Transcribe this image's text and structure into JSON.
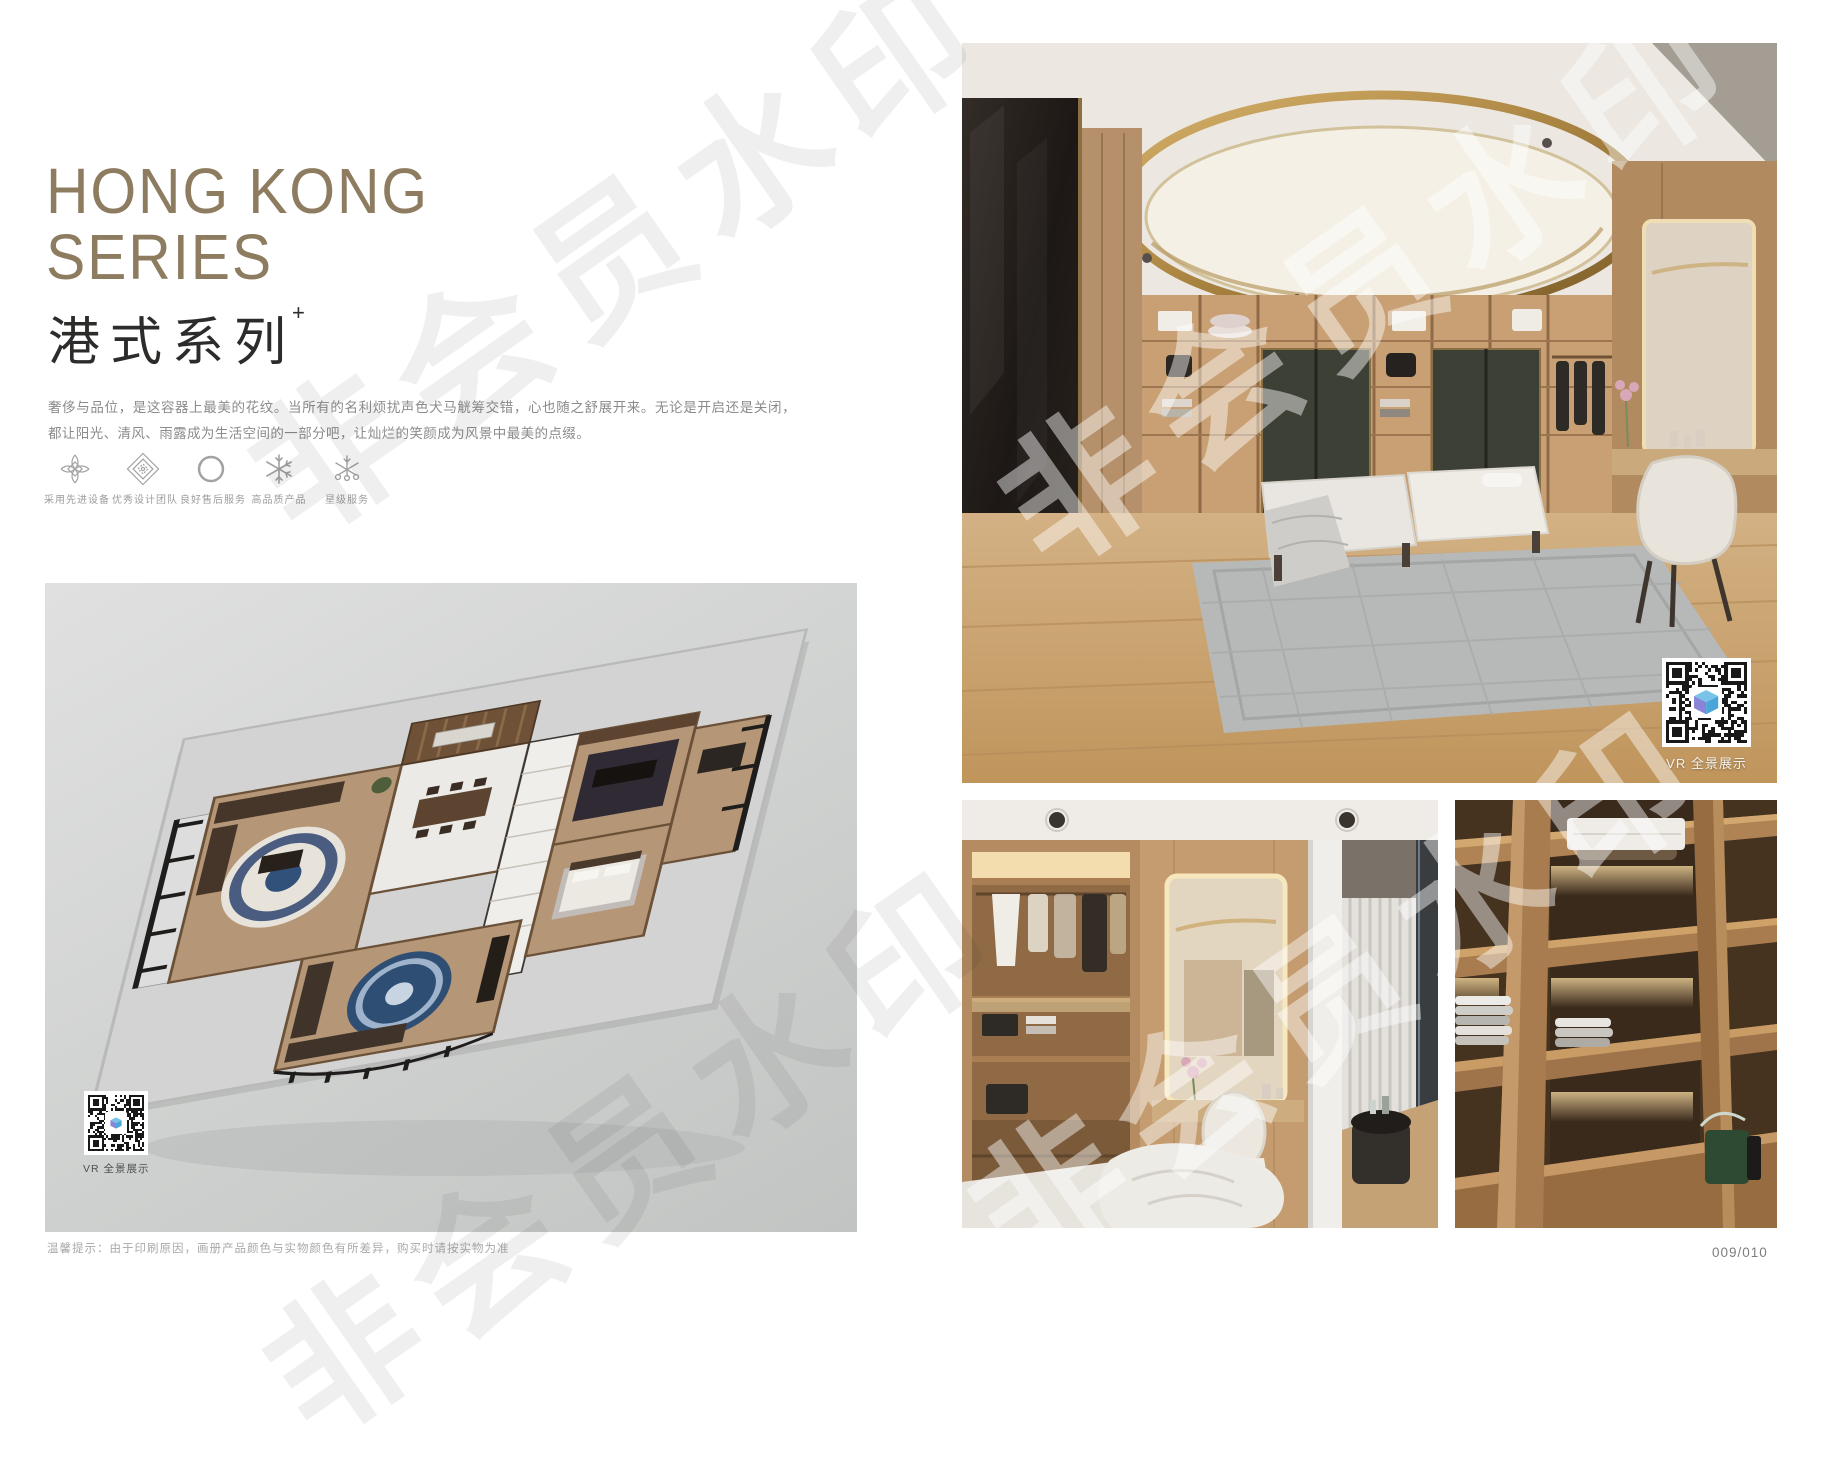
{
  "watermark": {
    "text": "非会员水印"
  },
  "left": {
    "title_line1": "HONG KONG",
    "title_line2": "SERIES",
    "subtitle_cn": "港式系列",
    "subtitle_sup": "+",
    "description": "奢侈与品位，是这容器上最美的花纹。当所有的名利烦扰声色犬马觥筹交错，心也随之舒展开来。无论是开启还是关闭，都让阳光、清风、雨露成为生活空间的一部分吧，让灿烂的笑颜成为风景中最美的点缀。",
    "features": [
      {
        "icon": "petal-diamond-icon",
        "label": "采用先进设备"
      },
      {
        "icon": "nested-diamond-icon",
        "label": "优秀设计团队"
      },
      {
        "icon": "ring-icon",
        "label": "良好售后服务"
      },
      {
        "icon": "snowflake-icon",
        "label": "高品质产品"
      },
      {
        "icon": "star-flake-icon",
        "label": "星级服务"
      }
    ],
    "floorplan_vr_label": "VR 全景展示"
  },
  "right": {
    "main_vr_label": "VR 全景展示"
  },
  "footer": {
    "disclaimer": "温馨提示：由于印刷原因，画册产品颜色与实物颜色有所差异，购买时请按实物为准",
    "page_number": "009/010"
  },
  "colors": {
    "title_accent": "#8d7c60",
    "subtitle_text": "#2e2c2a",
    "body_text": "#8b8b8b",
    "muted_text": "#a9a9a9",
    "qr_logo_top": "#7ac3e8",
    "qr_logo_left": "#8a84d8",
    "qr_logo_right": "#4aa6d8"
  }
}
